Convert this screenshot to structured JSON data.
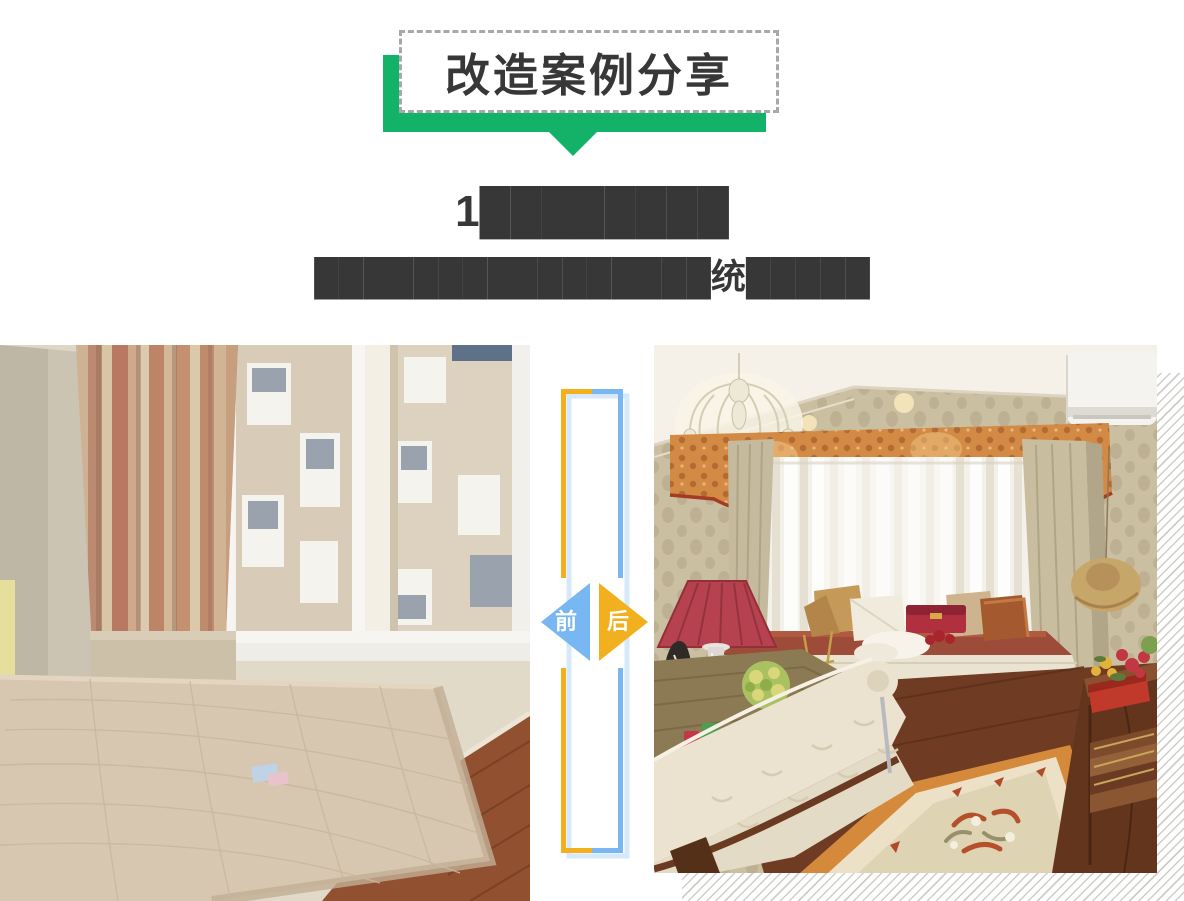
{
  "banner": {
    "title": "改造案例分享",
    "colors": {
      "ribbon_green": "#12b268",
      "box_border": "#a8a8a8",
      "text": "#373737"
    }
  },
  "headline": {
    "title_redacted": "1████████",
    "subtitle_redacted": "████████████████统█████",
    "text_color": "#373737"
  },
  "compare": {
    "before_label": "前",
    "after_label": "后",
    "colors": {
      "before_blue": "#79b7f2",
      "after_yellow": "#f2b01e",
      "frame_shadow_blue": "#d6e9fb",
      "backdrop_stripe": "#d0cdc9"
    }
  }
}
